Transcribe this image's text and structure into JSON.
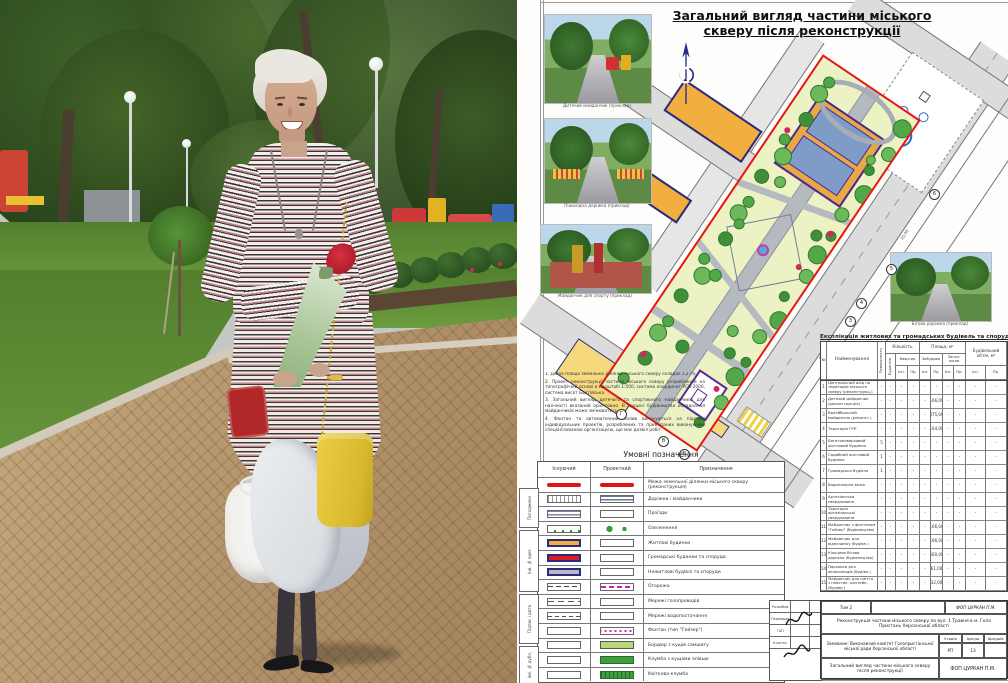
{
  "photo": {
    "description": "Woman with short platinum hair in a striped dress holding a wrapped red rose bouquet, a yellow handbag and a white jacket, standing on a brick path in a green park with playground, lawns, young trees and lamp posts"
  },
  "sheet": {
    "title_line1": "Загальний вигляд частини міського",
    "title_line2": "скверу після реконструкції",
    "example_photos": [
      {
        "caption": "Дитячий майданчик (приклад)"
      },
      {
        "caption": "Пішохідна доріжка (приклад)"
      },
      {
        "caption": "Майданчик для спорту (приклад)"
      },
      {
        "caption": "Бігова доріжка (приклад)"
      }
    ],
    "notes": [
      "1. Діюча площа земельної ділянки міського скверу складає 1,2 га.",
      "2. Проект реконструкції частини міського скверу розроблений на топографічній основі в масштабі 1:500, система координат УСК-2000, система висот Балтійська.",
      "3. Загальний вигляд дитячого та спортивного майданчиків для наочності вказаний орієнтовно. В процесі будівництва обладнання майданчиків може змінюватись.",
      "4. Фонтан та автоматичний полив виконуються на підставі індивідуальних проектів, розроблених та прив'язаних виконуючою спеціалізованою організацією, що має дозвіл робіт."
    ],
    "markers": [
      "3",
      "4",
      "5",
      "6",
      "А",
      "Б",
      "В",
      "Г"
    ],
    "dimensions": [
      "25,00",
      "40,00",
      "8,00",
      "4,00"
    ],
    "legend": {
      "title": "Умовні позначення",
      "columns": [
        "Існуючий",
        "Проектний",
        "Призначення"
      ],
      "rows": [
        {
          "ex": "line-red",
          "pr": "line-red",
          "label": "Межа земельної ділянки міського скверу (реконструкція)"
        },
        {
          "ex": "hatch-dots",
          "pr": "lines-gray",
          "label": "Доріжки і майданчики"
        },
        {
          "ex": "lines-purple",
          "pr": "empty",
          "label": "Проїзди"
        },
        {
          "ex": "dots-green",
          "pr": "trees",
          "label": "Озеленення"
        },
        {
          "ex": "bld-orange",
          "pr": "empty",
          "label": "Житлові будинки"
        },
        {
          "ex": "bld-red",
          "pr": "empty",
          "label": "Громадські будинки та споруди"
        },
        {
          "ex": "bld-gray",
          "pr": "empty",
          "label": "Нежитлові будівлі та споруди"
        },
        {
          "ex": "dashdot",
          "pr": "dash-magenta",
          "label": "Огорожа"
        },
        {
          "ex": "dash-g",
          "pr": "empty",
          "label": "Мережі газопроводів"
        },
        {
          "ex": "dash-v",
          "pr": "empty",
          "label": "Мережі водопостачання"
        },
        {
          "ex": "empty",
          "pr": "dots-magenta",
          "label": "Фонтан (тип \"Гейзер\")"
        },
        {
          "ex": "empty",
          "pr": "green-light",
          "label": "Бордюр з кущів самшиту"
        },
        {
          "ex": "empty",
          "pr": "green-solid",
          "label": "Клумба з кущами ялівцю"
        },
        {
          "ex": "empty",
          "pr": "green-hatch",
          "label": "Квіткова клумба"
        }
      ]
    },
    "table": {
      "title": "Експлікація житлових та громадських будівель та споруд",
      "groups": {
        "qty": "Кількість",
        "area": "Площа, м²",
        "vol": "Будівельний об'єм, м³"
      },
      "sub": {
        "n": "№",
        "name": "Найменування",
        "floors": "Поверховість",
        "bud": "Будинків",
        "kv": "Квартир",
        "zab": "Забудови",
        "zhil": "Загал. жили",
        "ex": "Існ.",
        "pr": "Пр."
      },
      "rows": [
        [
          "1",
          "Центральний вхід на територію міського скверу (реконструкц.)",
          "-",
          "-",
          "-",
          "-",
          "-",
          "-",
          "-",
          "-",
          "-",
          "-"
        ],
        [
          "2",
          "Дитячий майданчик (реконструкція)",
          "-",
          "-",
          "-",
          "-",
          "-",
          "166,00",
          "-",
          "-",
          "-",
          "-"
        ],
        [
          "3",
          "Волейбольний майданчик (реконст.)",
          "-",
          "-",
          "-",
          "-",
          "-",
          "875,00",
          "-",
          "-",
          "-",
          "-"
        ],
        [
          "4",
          "Територія ГРП",
          "-",
          "-",
          "-",
          "-",
          "-",
          "164,00",
          "-",
          "-",
          "-",
          "-"
        ],
        [
          "5",
          "Багатоповерховий житловий будинок",
          "5",
          "-",
          "-",
          "-",
          "-",
          "-",
          "-",
          "-",
          "-",
          "-"
        ],
        [
          "6",
          "Садибний житловий будинок",
          "1",
          "-",
          "-",
          "-",
          "-",
          "-",
          "-",
          "-",
          "-",
          "-"
        ],
        [
          "7",
          "Громадська будівля",
          "1",
          "-",
          "-",
          "-",
          "-",
          "-",
          "-",
          "-",
          "-",
          "-"
        ],
        [
          "8",
          "Водонапірна вежа",
          "-",
          "-",
          "-",
          "-",
          "-",
          "-",
          "-",
          "-",
          "-",
          "-"
        ],
        [
          "9",
          "Артезіанська свердловина",
          "-",
          "-",
          "-",
          "-",
          "-",
          "-",
          "-",
          "-",
          "-",
          "-"
        ],
        [
          "10",
          "Територія артезіанської свердловини",
          "-",
          "-",
          "-",
          "-",
          "-",
          "-",
          "-",
          "-",
          "-",
          "-"
        ],
        [
          "11",
          "Майданчик з фонтаном \"Гейзер\" (будівництво)",
          "-",
          "-",
          "-",
          "-",
          "-",
          "166,00",
          "-",
          "-",
          "-",
          "-"
        ],
        [
          "12",
          "Майданчик для відпочинку (будівн.)",
          "-",
          "-",
          "-",
          "-",
          "-",
          "166,00",
          "-",
          "-",
          "-",
          "-"
        ],
        [
          "13",
          "Кільцева бігова доріжка (будівництво)",
          "-",
          "-",
          "-",
          "-",
          "-",
          "560,00",
          "-",
          "-",
          "-",
          "-"
        ],
        [
          "14",
          "Парковка для велосипедів (будівн.)",
          "-",
          "-",
          "-",
          "-",
          "-",
          "61,00",
          "-",
          "-",
          "-",
          "-"
        ],
        [
          "15",
          "Майданчик для сміття з пластик. контейн. (будівн.)",
          "-",
          "-",
          "-",
          "-",
          "-",
          "32,00",
          "-",
          "-",
          "-",
          "-"
        ]
      ]
    },
    "stamp": {
      "tom": "Том 2",
      "code": "ФОП ЦУРКАН П.М.",
      "project": "Реконструкція частини міського скверу по вул. 1 Травня в м. Гола Пристань Херсонської області",
      "customer": "Замовник: Виконавчий комітет Голопристанської міської ради Херсонської області",
      "stage_h": [
        "Стадія",
        "Аркуш",
        "Аркушів"
      ],
      "stage_v": [
        "РП",
        "13",
        ""
      ],
      "sheet_name": "Загальний вигляд частини міського скверу після реконструкції",
      "firm": "ФОП ЦУРКАН П.М.",
      "sign_rows": [
        "Розробив",
        "Перевірив",
        "ГАП",
        "Н.контр."
      ]
    },
    "side_strip": [
      "Погоджено",
      "Інв. № ориг.",
      "Підпис і дата",
      "Інв. № дубл."
    ],
    "colors": {
      "boundary_red": "#e81515",
      "building_orange": "#f2ae3e",
      "building_yellow": "#f5d97c",
      "building_red": "#d82020",
      "navy": "#2a2a80",
      "park_green": "#edf2c4",
      "road_gray": "#dcdcdc"
    }
  }
}
